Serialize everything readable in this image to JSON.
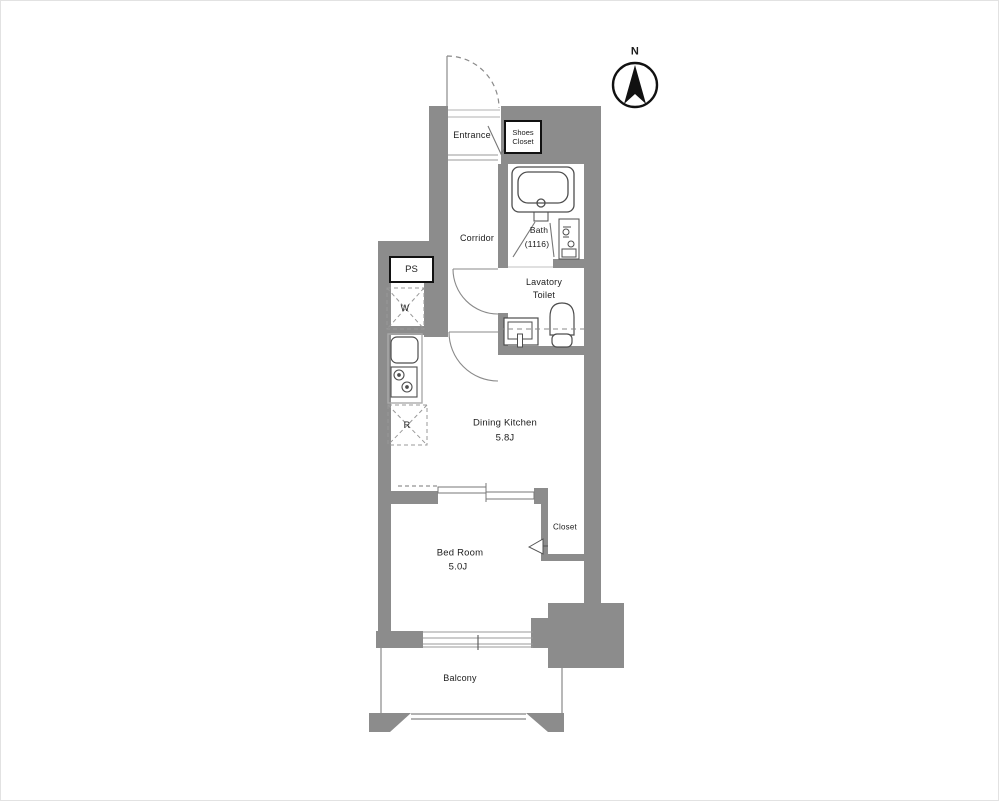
{
  "title": "apartment-floor-plan",
  "colors": {
    "wall": "#8c8c8c",
    "fixture": "#4d4d4d",
    "door": "#8a8a8a",
    "light": "#b0b0b0",
    "text": "#1c1c1c",
    "box": "#111111"
  },
  "compass": {
    "north": "N"
  },
  "labels": {
    "entrance": "Entrance",
    "shoes_closet_1": "Shoes",
    "shoes_closet_2": "Closet",
    "corridor": "Corridor",
    "bath_1": "Bath",
    "bath_2": "(1116)",
    "lavatory_1": "Lavatory",
    "lavatory_2": "Toilet",
    "pipe_space": "PS",
    "washer_space": "W",
    "fridge_space": "R",
    "dining_kitchen_1": "Dining Kitchen",
    "dining_kitchen_2": "5.8J",
    "bedroom_1": "Bed Room",
    "bedroom_2": "5.0J",
    "closet": "Closet",
    "balcony": "Balcony"
  }
}
